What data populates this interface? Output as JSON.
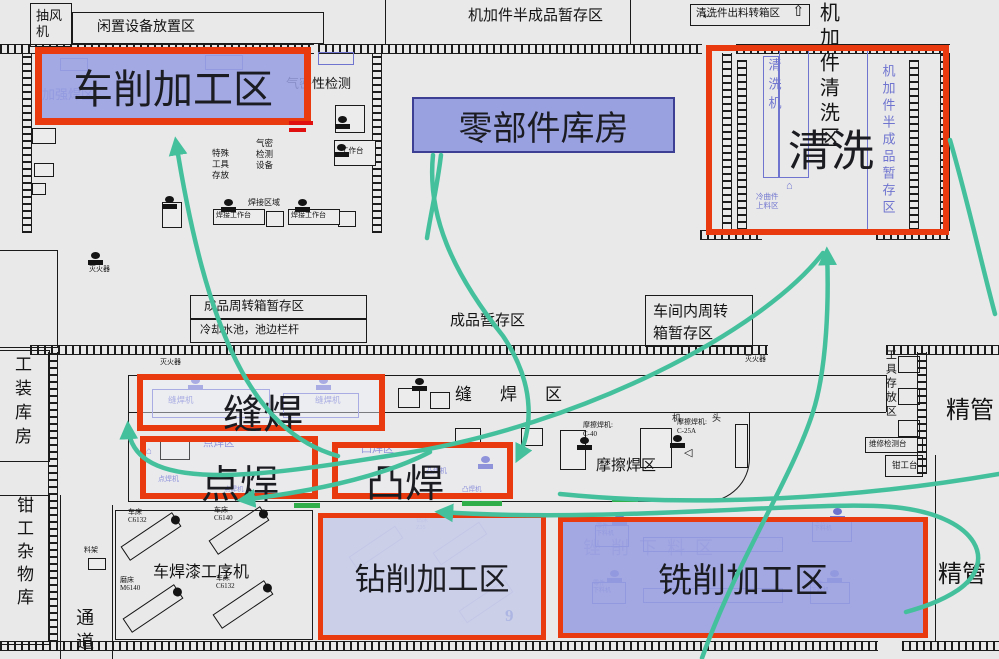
{
  "title": "工厂车间布置图（物流路线示意）",
  "colors": {
    "red": "#e8390f",
    "purple": "#6f74cf",
    "teal": "#44c09d",
    "green": "#2fae4a",
    "blue": "#2746c8",
    "black": "#141414",
    "region_fill": "#99a1e0",
    "warehouse_border": "#3d3f95"
  },
  "regions": [
    {
      "id": "chexiao",
      "label": "车削加工区",
      "x": 35,
      "y": 47,
      "w": 276,
      "h": 78,
      "fill": "rgba(153,159,225,0.88)",
      "border": "red",
      "bw": 7,
      "fs": 40,
      "centered": true
    },
    {
      "id": "lingbujian",
      "label": "零部件库房",
      "x": 412,
      "y": 97,
      "w": 263,
      "h": 56,
      "fill": "#99a1e0",
      "border": "#3d3f95",
      "bw": 2,
      "fs": 34,
      "centered": true
    },
    {
      "id": "qingxi",
      "label": "清洗",
      "x": 706,
      "y": 45,
      "w": 243,
      "h": 190,
      "fill": "none",
      "border": "red",
      "bw": 6,
      "fs": 43,
      "lx": 76,
      "ly": 66
    },
    {
      "id": "fenghan",
      "label": "缝焊",
      "x": 137,
      "y": 374,
      "w": 248,
      "h": 57,
      "fill": "rgba(240,241,250,0.45)",
      "border": "red",
      "bw": 6,
      "fs": 40,
      "lx": 80,
      "ly": 2
    },
    {
      "id": "dianhan",
      "label": "点焊",
      "x": 140,
      "y": 436,
      "w": 178,
      "h": 63,
      "fill": "rgba(240,241,250,0.25)",
      "border": "red",
      "bw": 6,
      "fs": 39,
      "lx": 55,
      "ly": 12
    },
    {
      "id": "tuhan",
      "label": "凸焊",
      "x": 332,
      "y": 442,
      "w": 181,
      "h": 57,
      "fill": "rgba(240,241,250,0.25)",
      "border": "red",
      "bw": 6,
      "fs": 39,
      "lx": 28,
      "ly": 5
    },
    {
      "id": "zuanxiao",
      "label": "钻削加工区",
      "x": 318,
      "y": 513,
      "w": 228,
      "h": 127,
      "fill": "rgba(198,202,232,0.85)",
      "border": "red",
      "bw": 5,
      "fs": 31,
      "centered": true
    },
    {
      "id": "xixiao",
      "label": "铣削加工区",
      "x": 558,
      "y": 517,
      "w": 370,
      "h": 121,
      "fill": "rgba(152,158,224,0.88)",
      "border": "red",
      "bw": 5,
      "fs": 34,
      "centered": true
    }
  ],
  "labels": [
    {
      "t": "抽风\n机",
      "x": 36,
      "y": 8,
      "s": 13,
      "lh": 16
    },
    {
      "t": "闲置设备放置区",
      "x": 97,
      "y": 20,
      "s": 14
    },
    {
      "t": "机加件半成品暂存区",
      "x": 468,
      "y": 8,
      "s": 15
    },
    {
      "t": "←",
      "x": 700,
      "y": 4,
      "s": 17
    },
    {
      "t": "清洗件出料转箱区",
      "x": 696,
      "y": 8,
      "s": 10.5
    },
    {
      "t": "⇧",
      "x": 792,
      "y": 4,
      "s": 15
    },
    {
      "t": "机加件清洗区",
      "x": 816,
      "y": 2,
      "s": 20,
      "o": "v",
      "ls": 5
    },
    {
      "t": "气密性检测",
      "x": 286,
      "y": 77,
      "s": 13
    },
    {
      "t": "特殊\n工具\n存放",
      "x": 212,
      "y": 148,
      "s": 8.5,
      "lh": 11
    },
    {
      "t": "气密\n检测\n设备",
      "x": 256,
      "y": 138,
      "s": 8.5,
      "lh": 11
    },
    {
      "t": "焊接区域",
      "x": 248,
      "y": 199,
      "s": 8
    },
    {
      "t": "焊接工作台",
      "x": 216,
      "y": 212,
      "s": 7
    },
    {
      "t": "焊接工作台",
      "x": 291,
      "y": 212,
      "s": 7
    },
    {
      "t": "工作台",
      "x": 341,
      "y": 147,
      "s": 7.5
    },
    {
      "t": "灭火器",
      "x": 89,
      "y": 266,
      "s": 7
    },
    {
      "t": "工装库房",
      "x": 12,
      "y": 355,
      "s": 17,
      "o": "v",
      "ls": 7
    },
    {
      "t": "成品周转箱暂存区",
      "x": 204,
      "y": 299,
      "s": 12.5
    },
    {
      "t": "冷却水池，池边栏杆",
      "x": 200,
      "y": 324,
      "s": 11
    },
    {
      "t": "成品暂存区",
      "x": 450,
      "y": 313,
      "s": 15
    },
    {
      "t": "车间内周转\n箱暂存区",
      "x": 653,
      "y": 301,
      "s": 15,
      "lh": 22
    },
    {
      "t": "灭火器",
      "x": 160,
      "y": 359,
      "s": 7
    },
    {
      "t": "灭火器",
      "x": 745,
      "y": 356,
      "s": 7
    },
    {
      "t": "缝焊区",
      "x": 455,
      "y": 385,
      "s": 17,
      "ls": 28
    },
    {
      "t": "摩擦焊区",
      "x": 596,
      "y": 458,
      "s": 15
    },
    {
      "t": "摩擦焊机:\nC-40",
      "x": 583,
      "y": 421,
      "s": 7,
      "lh": 9
    },
    {
      "t": "摩擦焊机:\nC-25A",
      "x": 677,
      "y": 418,
      "s": 7,
      "lh": 9
    },
    {
      "t": "机",
      "x": 672,
      "y": 413,
      "s": 9
    },
    {
      "t": "头",
      "x": 712,
      "y": 413,
      "s": 9
    },
    {
      "t": "◁",
      "x": 684,
      "y": 447,
      "s": 11
    },
    {
      "t": "工具存放区",
      "x": 884,
      "y": 349,
      "s": 11,
      "o": "v",
      "ls": 3
    },
    {
      "t": "精管",
      "x": 946,
      "y": 398,
      "s": 24
    },
    {
      "t": "精管",
      "x": 938,
      "y": 562,
      "s": 24
    },
    {
      "t": "维修检测台",
      "x": 869,
      "y": 440,
      "s": 7.5
    },
    {
      "t": "钳工台",
      "x": 892,
      "y": 461,
      "s": 8.5
    },
    {
      "t": "钳工杂物库",
      "x": 14,
      "y": 496,
      "s": 17,
      "o": "v",
      "ls": 6
    },
    {
      "t": "通道",
      "x": 74,
      "y": 608,
      "s": 18,
      "o": "v",
      "ls": 6
    },
    {
      "t": "料架",
      "x": 84,
      "y": 547,
      "s": 7
    },
    {
      "t": "车焊漆工序机",
      "x": 153,
      "y": 564,
      "s": 16
    },
    {
      "t": "车床\nC6132",
      "x": 128,
      "y": 508,
      "s": 7,
      "lh": 8
    },
    {
      "t": "车床\nC6140",
      "x": 214,
      "y": 506,
      "s": 7,
      "lh": 8
    },
    {
      "t": "磨床\nM6140",
      "x": 120,
      "y": 576,
      "s": 7,
      "lh": 8
    },
    {
      "t": "车床\nC6132",
      "x": 216,
      "y": 574,
      "s": 7,
      "lh": 8
    },
    {
      "t": "9",
      "x": 505,
      "y": 606,
      "s": 17,
      "c": "b",
      "bold": 1
    },
    {
      "t": "加强焊区",
      "x": 42,
      "y": 88,
      "s": 13,
      "c": "p"
    },
    {
      "t": "清洗机",
      "x": 766,
      "y": 58,
      "s": 13,
      "o": "v",
      "c": "p",
      "ls": 6
    },
    {
      "t": "机加件半成品暂存区",
      "x": 880,
      "y": 64,
      "s": 13,
      "o": "v",
      "c": "p",
      "ls": 4
    },
    {
      "t": "冷曲件\n上料区",
      "x": 756,
      "y": 192,
      "s": 7.5,
      "c": "p",
      "lh": 9
    },
    {
      "t": "⌂",
      "x": 786,
      "y": 180,
      "s": 11,
      "c": "p"
    },
    {
      "t": "缝焊机",
      "x": 168,
      "y": 396,
      "s": 8.5,
      "c": "p"
    },
    {
      "t": "缝焊机",
      "x": 315,
      "y": 396,
      "s": 8.5,
      "c": "p"
    },
    {
      "t": "点焊区",
      "x": 203,
      "y": 438,
      "s": 10.5,
      "c": "p"
    },
    {
      "t": "⌂",
      "x": 146,
      "y": 446,
      "s": 10,
      "c": "p"
    },
    {
      "t": "点焊机",
      "x": 158,
      "y": 476,
      "s": 7,
      "c": "p"
    },
    {
      "t": "点焊机",
      "x": 224,
      "y": 486,
      "s": 6.5,
      "c": "p"
    },
    {
      "t": "凸焊区",
      "x": 361,
      "y": 443,
      "s": 11,
      "c": "p"
    },
    {
      "t": "凸焊机",
      "x": 426,
      "y": 468,
      "s": 7,
      "c": "p"
    },
    {
      "t": "凸焊机",
      "x": 462,
      "y": 486,
      "s": 6.5,
      "c": "p"
    },
    {
      "t": "锉削下料区",
      "x": 583,
      "y": 538,
      "s": 18,
      "c": "p",
      "op": 0.5,
      "ls": 10
    },
    {
      "t": "零件\n下料机",
      "x": 596,
      "y": 524,
      "s": 6,
      "c": "p",
      "lh": 7
    },
    {
      "t": "零件\n下料机",
      "x": 814,
      "y": 519,
      "s": 6,
      "c": "p",
      "lh": 7
    },
    {
      "t": "零件\n下料机",
      "x": 593,
      "y": 581,
      "s": 6,
      "c": "p",
      "lh": 7
    },
    {
      "t": "零件\n下料机",
      "x": 811,
      "y": 581,
      "s": 6,
      "c": "p",
      "lh": 7
    },
    {
      "t": "钻床\nZ35",
      "x": 416,
      "y": 518,
      "s": 6,
      "c": "p",
      "op": 0.6,
      "lh": 7
    }
  ],
  "walls_h": [
    {
      "x": 0,
      "y": 44,
      "w": 314
    },
    {
      "x": 318,
      "y": 44,
      "w": 384
    },
    {
      "x": 736,
      "y": 44,
      "w": 214
    },
    {
      "x": 700,
      "y": 230,
      "w": 62
    },
    {
      "x": 876,
      "y": 230,
      "w": 74
    },
    {
      "x": 30,
      "y": 345,
      "w": 738
    },
    {
      "x": 886,
      "y": 345,
      "w": 113
    },
    {
      "x": 0,
      "y": 641,
      "w": 878
    },
    {
      "x": 902,
      "y": 641,
      "w": 97
    }
  ],
  "walls_v": [
    {
      "x": 22,
      "y": 53,
      "h": 180
    },
    {
      "x": 372,
      "y": 53,
      "h": 180
    },
    {
      "x": 722,
      "y": 53,
      "h": 178
    },
    {
      "x": 940,
      "y": 53,
      "h": 178
    },
    {
      "x": 737,
      "y": 60,
      "h": 170
    },
    {
      "x": 909,
      "y": 60,
      "h": 170
    },
    {
      "x": 48,
      "y": 352,
      "h": 290
    },
    {
      "x": 917,
      "y": 352,
      "h": 122
    }
  ],
  "lines": [
    {
      "x": 128,
      "y": 375,
      "w": 758
    },
    {
      "x": 128,
      "y": 412,
      "w": 758
    },
    {
      "x": 886,
      "y": 375,
      "h": 37
    },
    {
      "x": 128,
      "y": 375,
      "h": 37
    },
    {
      "x": 935,
      "y": 455,
      "h": 186
    },
    {
      "x": 385,
      "y": 0,
      "h": 44
    },
    {
      "x": 630,
      "y": 0,
      "h": 44
    },
    {
      "x": 867,
      "y": 50,
      "h": 182,
      "c": "p"
    },
    {
      "x": 60,
      "y": 495,
      "h": 164
    },
    {
      "x": 112,
      "y": 505,
      "h": 154
    }
  ],
  "rooms": [
    {
      "x": 30,
      "y": 3,
      "w": 42,
      "h": 44
    },
    {
      "x": 72,
      "y": 12,
      "w": 252,
      "h": 32
    },
    {
      "x": 690,
      "y": 4,
      "w": 120,
      "h": 22
    },
    {
      "x": 190,
      "y": 295,
      "w": 177,
      "h": 24
    },
    {
      "x": 190,
      "y": 319,
      "w": 177,
      "h": 24
    },
    {
      "x": 645,
      "y": 295,
      "w": 108,
      "h": 52
    },
    {
      "x": 865,
      "y": 437,
      "w": 58,
      "h": 16
    },
    {
      "x": 885,
      "y": 455,
      "w": 38,
      "h": 22
    },
    {
      "x": 898,
      "y": 356,
      "w": 22,
      "h": 17
    },
    {
      "x": 898,
      "y": 388,
      "w": 22,
      "h": 17
    },
    {
      "x": 898,
      "y": 420,
      "w": 22,
      "h": 17
    },
    {
      "x": 115,
      "y": 510,
      "w": 198,
      "h": 130
    },
    {
      "x": -2,
      "y": 495,
      "w": 52,
      "h": 150
    },
    {
      "x": -2,
      "y": 350,
      "w": 52,
      "h": 112
    },
    {
      "x": -2,
      "y": 250,
      "w": 60,
      "h": 98
    },
    {
      "x": 128,
      "y": 412,
      "w": 622,
      "h": 90,
      "round": 1
    }
  ],
  "wboxes": [
    {
      "x": 398,
      "y": 388,
      "w": 22,
      "h": 20
    },
    {
      "x": 430,
      "y": 392,
      "w": 20,
      "h": 17
    },
    {
      "x": 455,
      "y": 428,
      "w": 26,
      "h": 20
    },
    {
      "x": 521,
      "y": 428,
      "w": 22,
      "h": 18
    },
    {
      "x": 560,
      "y": 430,
      "w": 26,
      "h": 40
    },
    {
      "x": 640,
      "y": 428,
      "w": 32,
      "h": 40
    },
    {
      "x": 735,
      "y": 424,
      "w": 13,
      "h": 44
    },
    {
      "x": 160,
      "y": 438,
      "w": 30,
      "h": 22
    },
    {
      "x": 266,
      "y": 211,
      "w": 18,
      "h": 16
    },
    {
      "x": 338,
      "y": 211,
      "w": 18,
      "h": 16
    },
    {
      "x": 213,
      "y": 209,
      "w": 52,
      "h": 16
    },
    {
      "x": 288,
      "y": 209,
      "w": 52,
      "h": 16
    },
    {
      "x": 335,
      "y": 105,
      "w": 30,
      "h": 28
    },
    {
      "x": 334,
      "y": 140,
      "w": 42,
      "h": 26
    },
    {
      "x": 32,
      "y": 128,
      "w": 24,
      "h": 16
    },
    {
      "x": 34,
      "y": 163,
      "w": 20,
      "h": 14
    },
    {
      "x": 32,
      "y": 183,
      "w": 14,
      "h": 12
    },
    {
      "x": 88,
      "y": 558,
      "w": 18,
      "h": 12
    },
    {
      "x": 162,
      "y": 202,
      "w": 20,
      "h": 26
    }
  ],
  "pboxes": [
    {
      "x": 763,
      "y": 56,
      "w": 16,
      "h": 122
    },
    {
      "x": 779,
      "y": 50,
      "w": 30,
      "h": 128
    },
    {
      "x": 643,
      "y": 537,
      "w": 140,
      "h": 15
    },
    {
      "x": 643,
      "y": 588,
      "w": 140,
      "h": 15
    },
    {
      "x": 595,
      "y": 525,
      "w": 34,
      "h": 22
    },
    {
      "x": 812,
      "y": 520,
      "w": 40,
      "h": 22
    },
    {
      "x": 592,
      "y": 582,
      "w": 34,
      "h": 22
    },
    {
      "x": 810,
      "y": 582,
      "w": 40,
      "h": 22
    },
    {
      "x": 152,
      "y": 389,
      "w": 118,
      "h": 29
    },
    {
      "x": 283,
      "y": 393,
      "w": 76,
      "h": 25
    },
    {
      "x": 60,
      "y": 58,
      "w": 28,
      "h": 13
    },
    {
      "x": 205,
      "y": 55,
      "w": 38,
      "h": 15
    },
    {
      "x": 318,
      "y": 52,
      "w": 36,
      "h": 13
    }
  ],
  "machines": [
    {
      "x": 120,
      "y": 528
    },
    {
      "x": 208,
      "y": 522
    },
    {
      "x": 122,
      "y": 600
    },
    {
      "x": 212,
      "y": 596
    }
  ],
  "fmachines": [
    {
      "x": 348,
      "y": 540
    },
    {
      "x": 432,
      "y": 536
    },
    {
      "x": 458,
      "y": 594
    }
  ],
  "pumps": [
    {
      "x": 335,
      "y": 116,
      "k": "k"
    },
    {
      "x": 334,
      "y": 144,
      "k": "k"
    },
    {
      "x": 162,
      "y": 196,
      "k": "k"
    },
    {
      "x": 221,
      "y": 199,
      "k": "k"
    },
    {
      "x": 295,
      "y": 199,
      "k": "k"
    },
    {
      "x": 412,
      "y": 378,
      "k": "k"
    },
    {
      "x": 577,
      "y": 437,
      "k": "k"
    },
    {
      "x": 670,
      "y": 435,
      "k": "k"
    },
    {
      "x": 88,
      "y": 252,
      "k": "k"
    },
    {
      "x": 188,
      "y": 377,
      "k": "p"
    },
    {
      "x": 316,
      "y": 377,
      "k": "p"
    },
    {
      "x": 478,
      "y": 456,
      "k": "p"
    },
    {
      "x": 612,
      "y": 512,
      "k": "p"
    },
    {
      "x": 830,
      "y": 508,
      "k": "p"
    },
    {
      "x": 607,
      "y": 570,
      "k": "p"
    },
    {
      "x": 827,
      "y": 570,
      "k": "p"
    }
  ],
  "marks": [
    {
      "x": 294,
      "y": 503,
      "w": 26,
      "h": 5,
      "c": "#2fae4a"
    },
    {
      "x": 462,
      "y": 501,
      "w": 40,
      "h": 5,
      "c": "#2fae4a"
    },
    {
      "x": 612,
      "y": 497,
      "w": 26,
      "h": 5,
      "c": "#2fae4a"
    },
    {
      "x": 289,
      "y": 121,
      "w": 24,
      "h": 4,
      "c": "#e01010"
    },
    {
      "x": 289,
      "y": 128,
      "w": 17,
      "h": 4,
      "c": "#e01010"
    }
  ],
  "arrows": [
    {
      "d": "M 338 456 C 252 432, 206 330, 176 142",
      "head": "end"
    },
    {
      "d": "M 433 155 C 427 215, 452 272, 503 336 C 538 388, 531 432, 518 458",
      "head": "end"
    },
    {
      "d": "M 441 155 C 437 188, 431 212, 427 238",
      "head": "none"
    },
    {
      "d": "M 823 253 C 762 332, 580 426, 400 454 C 258 477, 132 496, 128 426",
      "head": "end"
    },
    {
      "d": "M 702 658 C 736 562, 792 478, 813 412 C 827 368, 829 300, 827 252",
      "head": "end"
    },
    {
      "d": "M 440 512 C 620 524, 830 498, 902 508 C 978 518, 998 562, 958 590 C 940 602, 920 608, 906 612",
      "head": "start"
    },
    {
      "d": "M 950 140 C 968 202, 980 258, 995 314",
      "head": "none"
    },
    {
      "d": "M 560 494 C 700 508, 860 498, 999 474",
      "head": "none"
    },
    {
      "d": "M 430 452 C 380 478, 308 492, 242 500",
      "head": "end"
    }
  ]
}
